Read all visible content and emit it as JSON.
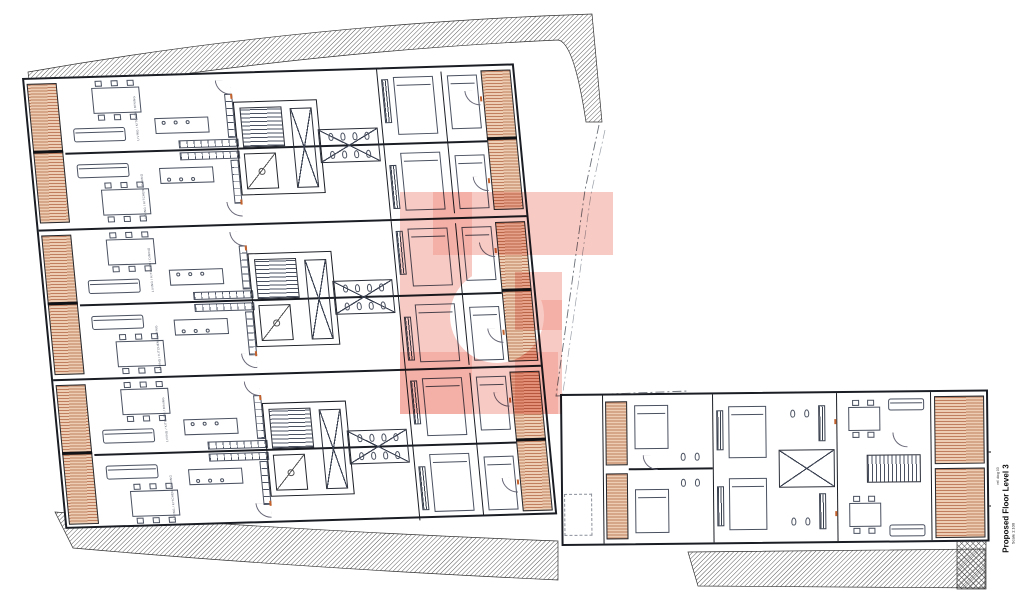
{
  "drawing": {
    "title": "Proposed Floor Level 3",
    "scale_label": "Scale 1:100",
    "ref_label": "ref. dwg 03",
    "watermark_letter": "G",
    "room_label": "LIVING / KITCHEN / DINING",
    "colors": {
      "wall": "#1a1d24",
      "furniture_line": "#4a5160",
      "deck_fill": "#edcdb3",
      "deck_line": "#9a3d18",
      "boundary_hatch": "#4a4a4a",
      "watermark": "#f2958a",
      "accent_orange": "#c4622d",
      "paper": "#ffffff"
    }
  }
}
